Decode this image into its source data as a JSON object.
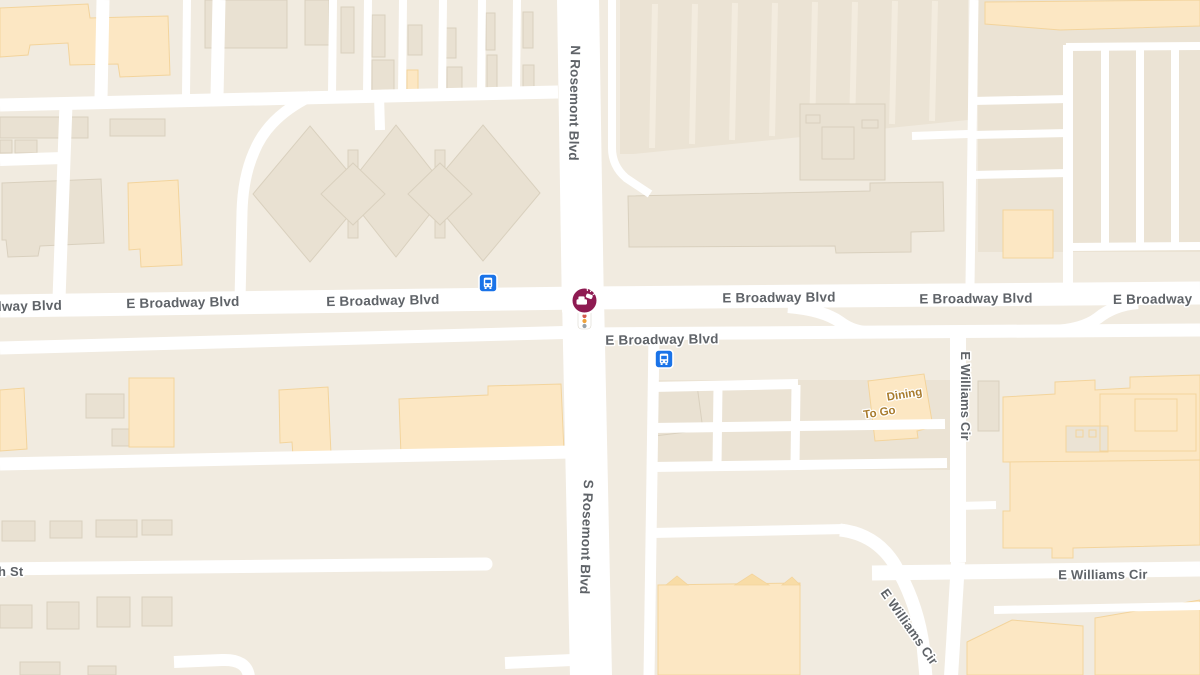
{
  "map": {
    "type": "street-map-viewport",
    "area_hint": "E Broadway Blvd and Rosemont Blvd intersection with E Williams Cir",
    "colors": {
      "background": "#f1ebe0",
      "road": "#ffffff",
      "building_gray": "#e9e1d2",
      "building_gray_border": "#d9d0be",
      "building_orange": "#fce7c3",
      "building_orange_border": "#f3d49c",
      "parking_lot": "#ebe3d4",
      "parking_stripe": "#f3ecdf",
      "label_text": "#5f6368",
      "poi_text": "#a87b2d",
      "transit_blue": "#1a73e8",
      "incident_maroon": "#8e1b52",
      "signal_red": "#d25a4e",
      "signal_amber": "#efa33c",
      "signal_gray": "#97a0a7"
    },
    "road_labels": {
      "broadway": "E Broadway Blvd",
      "broadway_partial_left": "lway Blvd",
      "broadway_partial_right": "E Broadway",
      "n_rosemont": "N Rosemont Blvd",
      "s_rosemont": "S Rosemont Blvd",
      "williams": "E Williams Cir",
      "side_street_partial": "h St"
    },
    "poi_labels": {
      "dining_line1": "Dining",
      "dining_line2": "To Go"
    },
    "icons": {
      "bus_stop": "bus-stop",
      "incident": "car-crash-incident",
      "traffic_signal": "traffic-signal"
    }
  }
}
